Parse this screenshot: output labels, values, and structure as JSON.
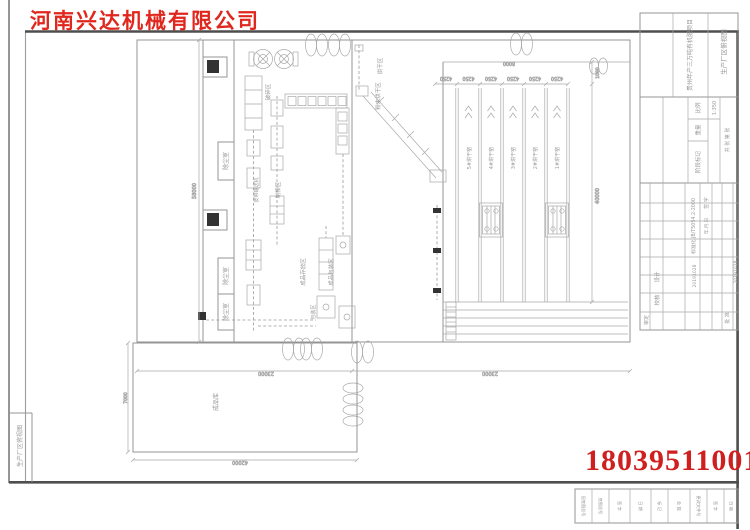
{
  "brand": {
    "company_name": "河南兴达机械有限公司",
    "phone_number": "18039511001",
    "red": "#d0221c"
  },
  "sheet": {
    "corner_title": "生产厂区俯视图",
    "strip": [
      "旧底图总号",
      "底图总号",
      "签 字",
      "日 期",
      "标 记",
      "处 数",
      "更改文件号",
      "签 字",
      "日 期"
    ]
  },
  "tb": {
    "project": "贵州年产三万吨有机肥项目",
    "title": "生产厂区俯视图",
    "scale_label": "比例",
    "scale_value": "1:350",
    "weight_label": "重量",
    "stage_label": "阶段标记",
    "sheets_label": "共 张 第 张",
    "std": "标准化 JB/T5054.2-2000",
    "sign_label": "签 字",
    "date_label": "年.月.日",
    "design": "设计",
    "check": "校核",
    "review": "审定",
    "approve": "批 准",
    "date1": "20191028",
    "date2": "20191028"
  },
  "plant": {
    "dust_room": "除尘室",
    "warehouse": "成品库",
    "area_dry": "烘干区",
    "area_powder": "粉末烘干区",
    "area_crush": "破碎区",
    "area_rod": "制棒区",
    "area_belt": "皮带输送机",
    "area_store": "成品存放区",
    "area_pack": "成品包装区",
    "area_pack2": "包装区",
    "kilns": [
      "5#烘干窑",
      "4#烘干窑",
      "3#烘干窑",
      "2#烘干窑",
      "1#烘干窑"
    ]
  },
  "dims": {
    "lane": "4250",
    "top": "8000",
    "offset": "1000",
    "length": "40000",
    "left": "58000",
    "bottom_a": "23000",
    "bottom_b": "23000",
    "wh_w": "42000",
    "wh_h": "7000"
  }
}
